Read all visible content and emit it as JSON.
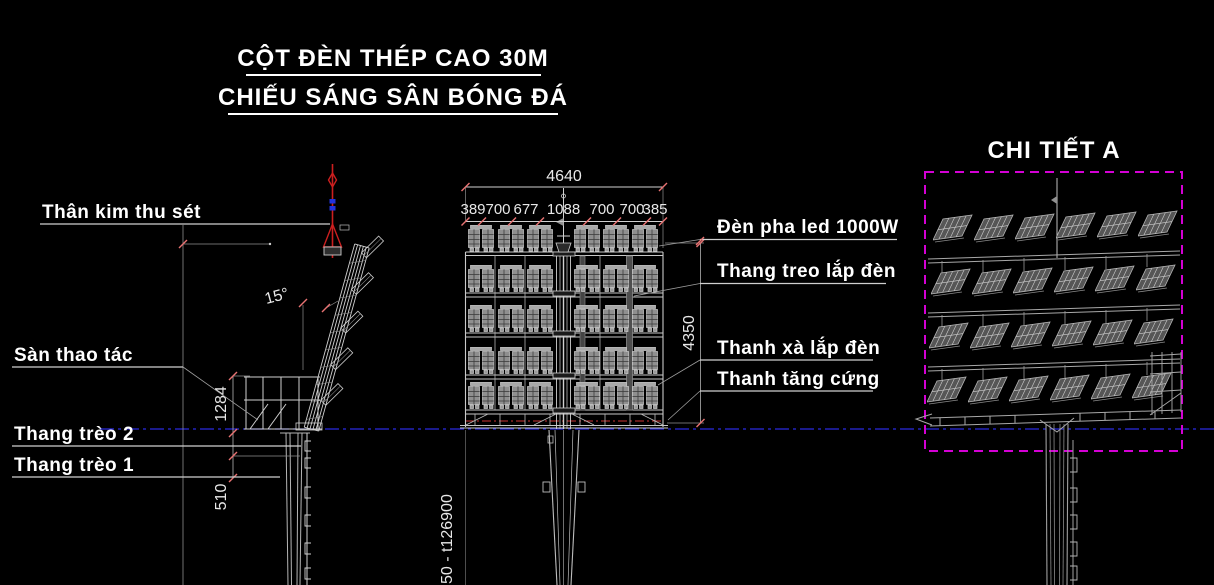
{
  "title": {
    "line1": "CỘT ĐÈN THÉP CAO 30M",
    "line2": "CHIẾU SÁNG SÂN BÓNG ĐÁ"
  },
  "detail": {
    "title": "CHI TIẾT A"
  },
  "left_view": {
    "labels": {
      "lightning_rod": "Thân kim thu sét",
      "platform": "Sàn thao tác",
      "ladder2": "Thang trèo 2",
      "ladder1": "Thang trèo 1"
    },
    "dims": {
      "angle": "15°",
      "platform_height": "1284",
      "ladder_spacing": "510"
    }
  },
  "front_view": {
    "dims": {
      "total_width": "4640",
      "segments": [
        "389",
        "700",
        "677",
        "1088",
        "700",
        "700",
        "385"
      ],
      "height": "4350"
    },
    "labels": {
      "floodlight": "Đèn pha led 1000W",
      "hanging_ladder": "Thang treo lắp đèn",
      "crossbar": "Thanh xà lắp đèn",
      "stiffener": "Thanh tăng cứng"
    },
    "pole_note": "50 - t126900"
  },
  "colors": {
    "background": "#000000",
    "drawing_line": "#d9d9d9",
    "dim_tick_red": "#e87272",
    "centerline_blue": "#2a2ae0",
    "lightning_rod_red": "#cc1f1f",
    "detail_border_magenta": "#d400d4",
    "text": "#ffffff"
  }
}
